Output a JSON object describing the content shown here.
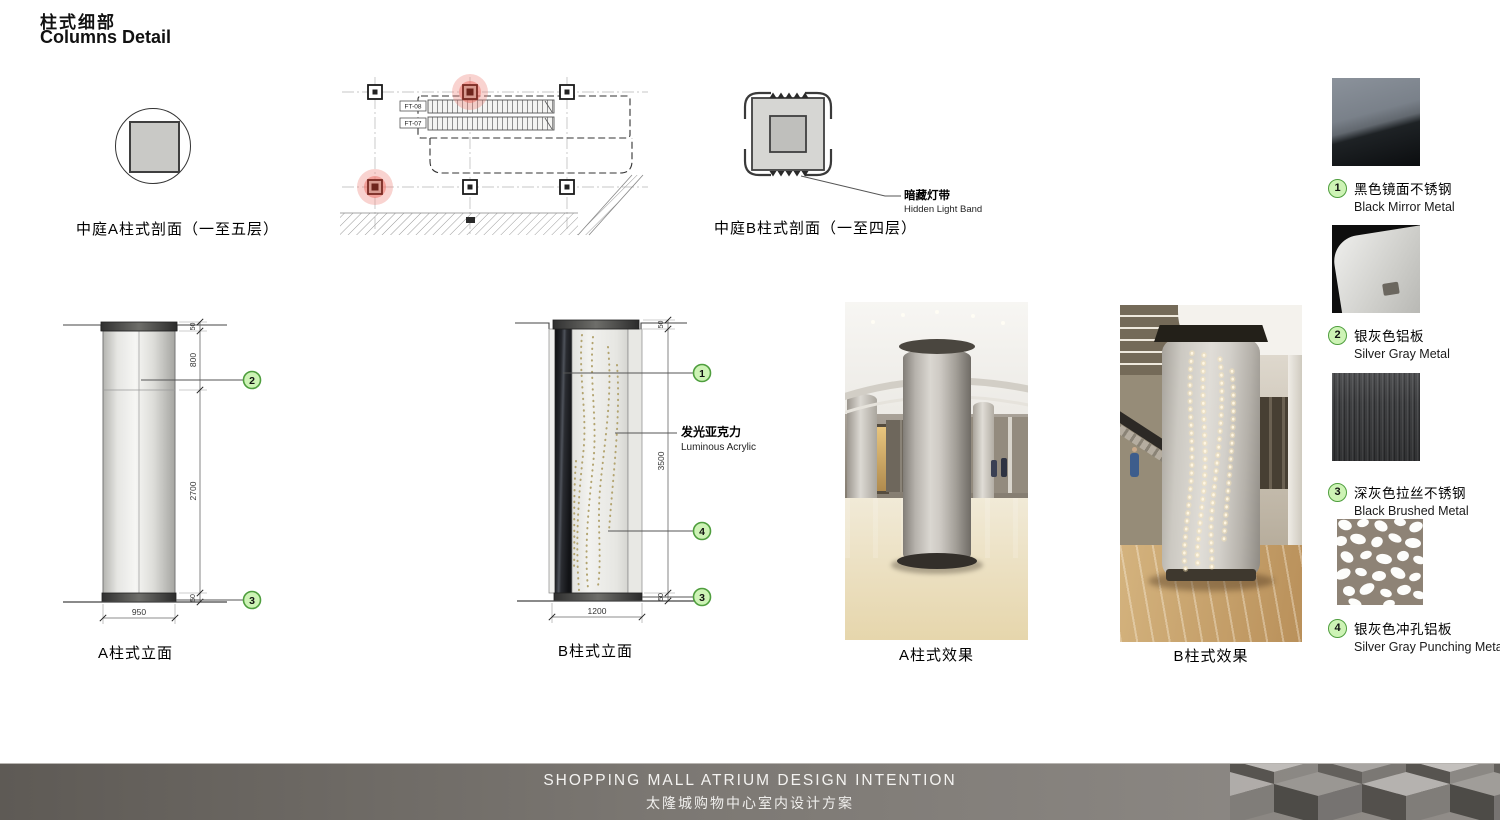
{
  "page": {
    "title_cn": "柱式细部",
    "title_en": "Columns Detail"
  },
  "plan": {
    "escalators": [
      "FT-08",
      "FT-07"
    ]
  },
  "section_a": {
    "label": "中庭A柱式剖面（一至五层）"
  },
  "section_b": {
    "label": "中庭B柱式剖面（一至四层）",
    "light_band_cn": "暗藏灯带",
    "light_band_en": "Hidden Light Band"
  },
  "elevation_a": {
    "label": "A柱式立面",
    "dim_cap": "50",
    "dim_upper": "800",
    "dim_main": "2700",
    "dim_base": "50",
    "dim_width": "950",
    "callout_mid": "2",
    "callout_base": "3"
  },
  "elevation_b": {
    "label": "B柱式立面",
    "dim_cap": "50",
    "dim_height": "3500",
    "dim_base": "50",
    "dim_width": "1200",
    "callout_top": "1",
    "callout_mid": "4",
    "callout_base": "3",
    "acrylic_cn": "发光亚克力",
    "acrylic_en": "Luminous Acrylic"
  },
  "photos": {
    "a_label": "A柱式效果",
    "b_label": "B柱式效果"
  },
  "materials": [
    {
      "num": "1",
      "cn": "黑色镜面不锈钢",
      "en": "Black Mirror Metal"
    },
    {
      "num": "2",
      "cn": "银灰色铝板",
      "en": "Silver Gray Metal"
    },
    {
      "num": "3",
      "cn": "深灰色拉丝不锈钢",
      "en": "Black Brushed Metal"
    },
    {
      "num": "4",
      "cn": "银灰色冲孔铝板",
      "en": "Silver Gray Punching Metal"
    }
  ],
  "footer": {
    "en": "SHOPPING MALL ATRIUM DESIGN INTENTION",
    "cn": "太隆城购物中心室内设计方案"
  },
  "colors": {
    "callout_fill": "#cdf3b5",
    "callout_border": "#4f9e3e",
    "highlight_pink": "#ef8078",
    "footer_dark": "#5e5a55",
    "footer_light": "#918d89"
  }
}
